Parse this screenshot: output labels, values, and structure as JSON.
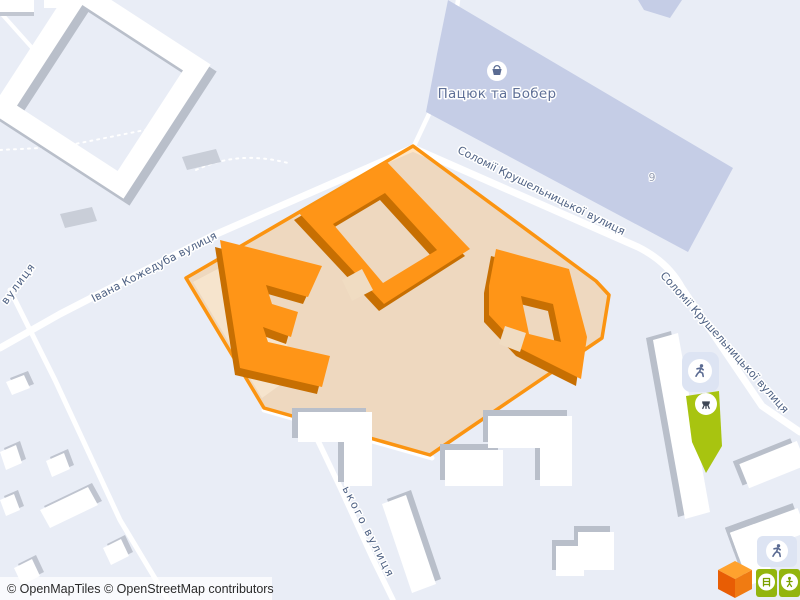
{
  "map": {
    "background_color": "#e9edf6",
    "attribution": "© OpenMapTiles © OpenStreetMap contributors",
    "poi": {
      "name": "Пацюк та Бобер",
      "icon": "shopping-basket-icon"
    },
    "house_number": "9",
    "street_labels": [
      {
        "name": "Соломії Крушельницької вулиця"
      },
      {
        "name": "Соломії Крушельницької вулиця"
      },
      {
        "name": "Івана Кожедуба вулиця"
      },
      {
        "name": "ького вулиця"
      },
      {
        "name": "вулиця"
      }
    ],
    "highlight": {
      "area_fill": "#f2dcc2",
      "border_color": "#fb9411",
      "building_fill": "#ff9517",
      "building_shadow": "#c76f02"
    },
    "colors": {
      "road": "#ffffff",
      "building_white": "#ffffff",
      "building_shadow_gray": "#b9bfca",
      "industrial_building": "#c5cde6",
      "green_area": "#a2c30d",
      "street_label": "#4e6183"
    },
    "icons": [
      "shopping-basket-icon",
      "runner-icon",
      "playground-ladder-icon",
      "playground-person-icon",
      "bbq-icon"
    ],
    "logo": "maptiler-cube-logo"
  }
}
